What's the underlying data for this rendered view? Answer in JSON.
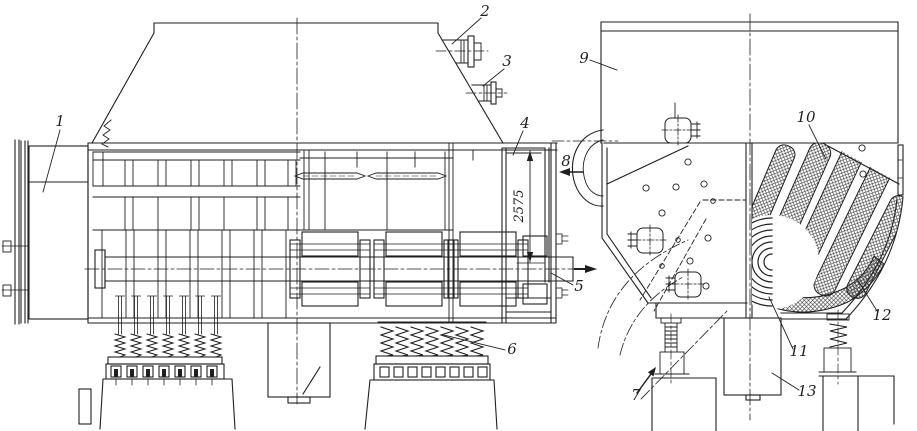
{
  "palette": {
    "ink": "#1f1f1f",
    "paper": "#ffffff",
    "hatch": "#2a2a2a"
  },
  "callouts": [
    {
      "label": "1"
    },
    {
      "label": "2"
    },
    {
      "label": "3"
    },
    {
      "label": "4"
    },
    {
      "label": "5"
    },
    {
      "label": "6"
    },
    {
      "label": "7"
    },
    {
      "label": "8"
    },
    {
      "label": "9"
    },
    {
      "label": "10"
    },
    {
      "label": "11"
    },
    {
      "label": "12"
    },
    {
      "label": "13"
    }
  ],
  "dimension": {
    "value": "2575"
  }
}
